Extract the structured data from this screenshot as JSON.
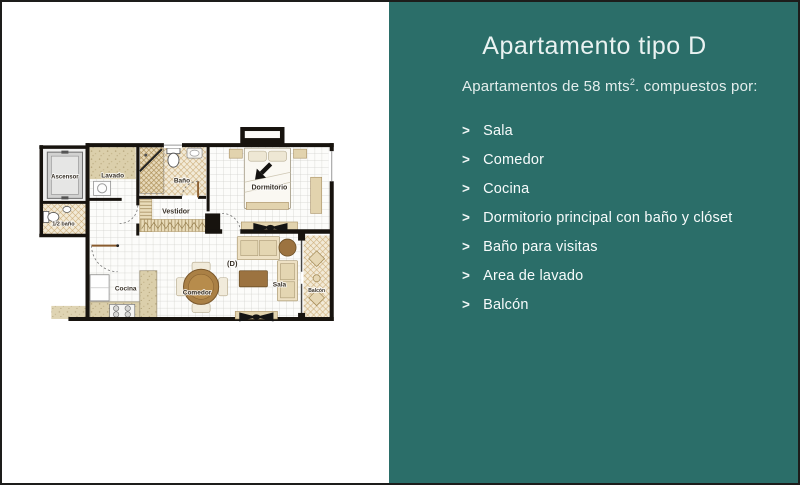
{
  "panel": {
    "title": "Apartamento tipo D",
    "subtitle_pre": "Apartamentos de 58 mts",
    "subtitle_sup": "2",
    "subtitle_post": ". compuestos por:",
    "bullet": ">",
    "items": [
      "Sala",
      "Comedor",
      "Cocina",
      "Dormitorio principal con baño y clóset",
      "Baño para visitas",
      "Area de lavado",
      "Balcón"
    ],
    "bg_color": "#2b6e69",
    "title_color": "#e9f2f1",
    "text_color": "#f7fbfb"
  },
  "floorplan": {
    "rooms": {
      "ascensor": "Ascensor",
      "lavado": "Lavado",
      "bano": "Baño",
      "dormitorio": "Dormitorio",
      "medio_bano": "1/2 baño",
      "vestidor": "Vestidor",
      "cocina": "Cocina",
      "comedor": "Comedor",
      "sala": "Sala",
      "balcon": "Balcón",
      "unit_label": "(D)"
    },
    "colors": {
      "wall": "#17130e",
      "furniture_beige": "#e2d3ae",
      "wood_brown": "#9c7340",
      "hatch_line": "#c9a76f"
    }
  }
}
